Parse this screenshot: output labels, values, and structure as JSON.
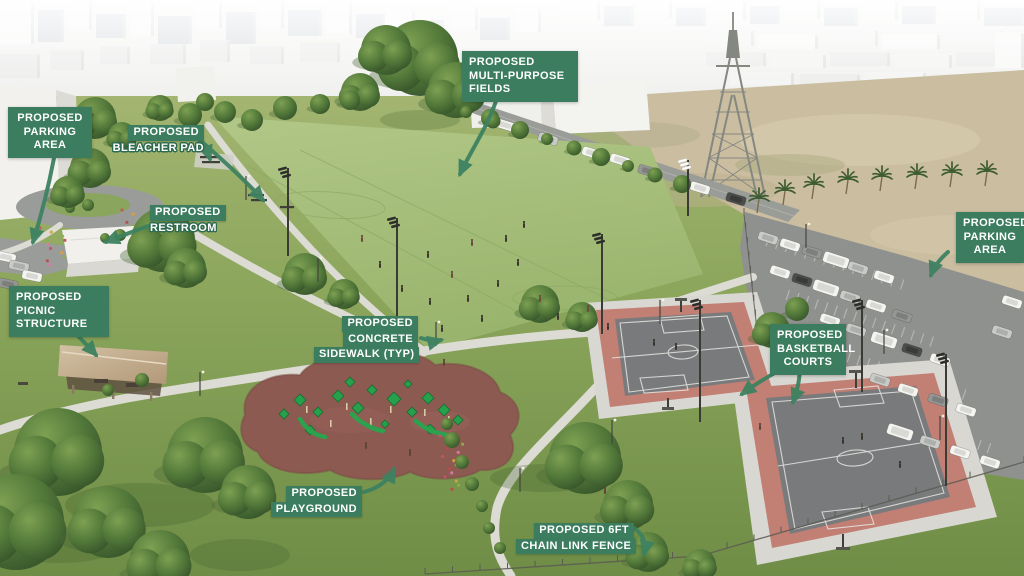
{
  "labels": {
    "parking_left": {
      "lines": [
        "PROPOSED",
        "PARKING",
        "AREA"
      ]
    },
    "bleacher_pad": {
      "lines": [
        "PROPOSED",
        "BLEACHER PAD"
      ]
    },
    "restroom": {
      "lines": [
        "PROPOSED",
        "RESTROOM"
      ]
    },
    "multipurpose_fields": {
      "lines": [
        "PROPOSED",
        "MULTI-PURPOSE",
        "FIELDS"
      ]
    },
    "picnic_structure": {
      "lines": [
        "PROPOSED",
        "PICNIC",
        "STRUCTURE"
      ]
    },
    "concrete_sidewalk": {
      "lines": [
        "PROPOSED",
        "CONCRETE",
        "SIDEWALK (TYP)"
      ]
    },
    "playground": {
      "lines": [
        "PROPOSED",
        "PLAYGROUND"
      ]
    },
    "parking_right": {
      "lines": [
        "PROPOSED",
        "PARKING",
        "AREA"
      ]
    },
    "basketball_courts": {
      "lines": [
        "PROPOSED",
        "BASKETBALL",
        "COURTS"
      ]
    },
    "chain_link_fence": {
      "lines": [
        "PROPOSED 6FT",
        "CHAIN LINK FENCE"
      ]
    }
  },
  "colors": {
    "label_green": "#3b7d5e",
    "arrow_green": "#3e8261",
    "court_red": "#c27f74",
    "court_gray": "#797a7b",
    "playground_surface": "#8d5a52",
    "field_green": "#a5bd78",
    "park_green": "#8ca65c",
    "dirt_tan": "#cabda0",
    "asphalt": "#8f918f",
    "sidewalk": "#dcdbd4"
  }
}
